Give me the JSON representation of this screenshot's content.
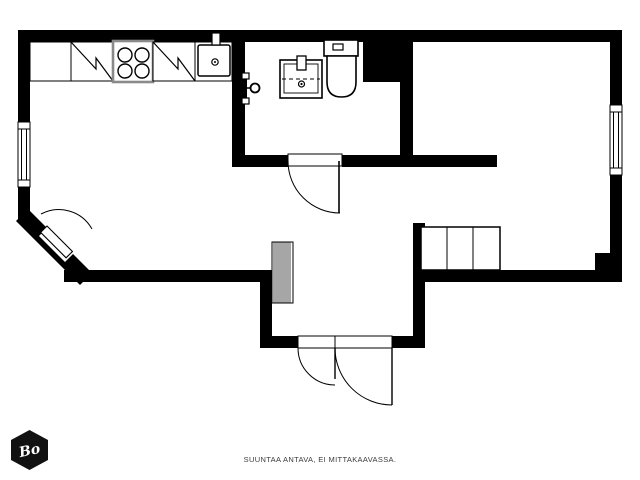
{
  "footer": {
    "note": "SUUNTAA ANTAVA, EI MITTAKAAVASSA."
  },
  "logo": {
    "text": "Bo"
  },
  "colors": {
    "wall": "#000000",
    "background": "#ffffff",
    "fixture_stroke": "#000000",
    "stove_border": "#8a8a8a",
    "footer_text": "#3b3b3b",
    "logo_background": "#111111",
    "logo_text": "#ffffff"
  },
  "plan": {
    "type": "apartment-floor-plan",
    "style": "black-and-white line drawing",
    "elements": [
      "kitchen-counter",
      "appliance-symbol-left",
      "stove-4-burners",
      "appliance-symbol-right",
      "kitchen-sink",
      "bathroom-washbasin",
      "toilet",
      "shower-mixer",
      "window-left-wall",
      "window-right-wall",
      "bathroom-door",
      "diagonal-corner-door",
      "entry-double-door",
      "hatched-wardrobe",
      "closet-3-sections",
      "service-shaft"
    ]
  }
}
